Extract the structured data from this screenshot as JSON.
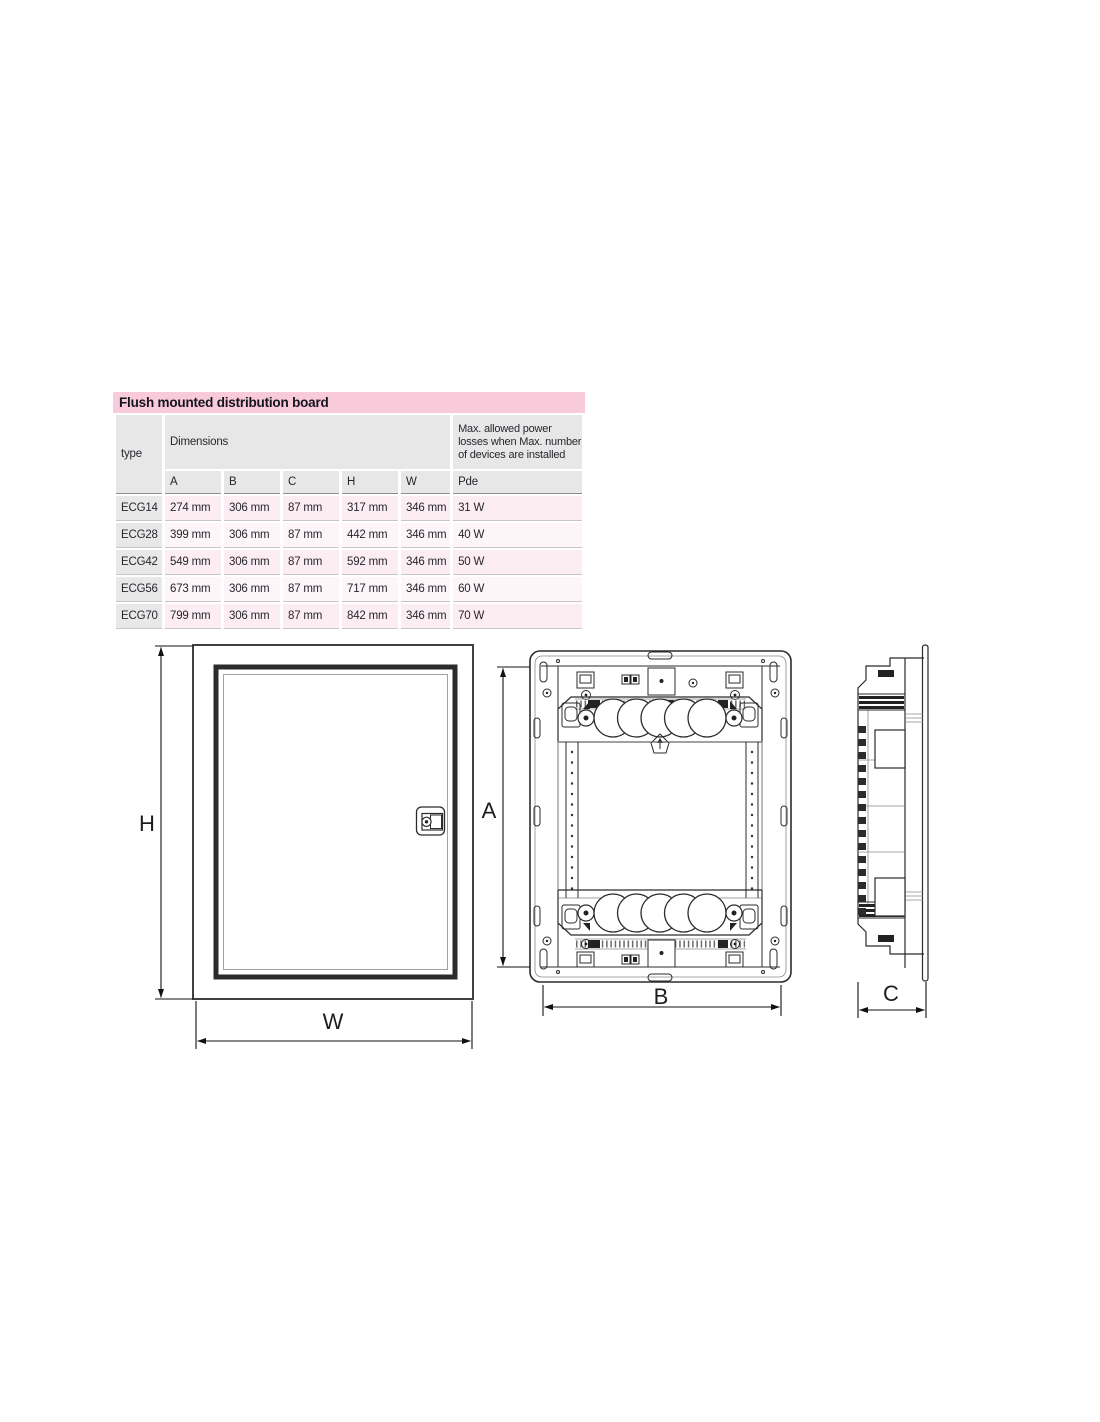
{
  "table": {
    "title": "Flush mounted distribution board",
    "header": {
      "type_label": "type",
      "dimensions_label": "Dimensions",
      "dim_columns": [
        "A",
        "B",
        "C",
        "H",
        "W"
      ],
      "power_note": "Max. allowed power losses when Max. number of devices are installed",
      "power_unit_label": "Pde"
    },
    "rows": [
      {
        "type": "ECG14",
        "a": "274 mm",
        "b": "306 mm",
        "c": "87 mm",
        "h": "317 mm",
        "w": "346 mm",
        "pde": "31 W"
      },
      {
        "type": "ECG28",
        "a": "399 mm",
        "b": "306 mm",
        "c": "87 mm",
        "h": "442 mm",
        "w": "346 mm",
        "pde": "40 W"
      },
      {
        "type": "ECG42",
        "a": "549 mm",
        "b": "306 mm",
        "c": "87 mm",
        "h": "592 mm",
        "w": "346 mm",
        "pde": "50 W"
      },
      {
        "type": "ECG56",
        "a": "673 mm",
        "b": "306 mm",
        "c": "87 mm",
        "h": "717 mm",
        "w": "346 mm",
        "pde": "60 W"
      },
      {
        "type": "ECG70",
        "a": "799 mm",
        "b": "306 mm",
        "c": "87 mm",
        "h": "842 mm",
        "w": "346 mm",
        "pde": "70 W"
      }
    ],
    "colors": {
      "title_bg": "#f9cada",
      "header_bg": "#e8e7e7",
      "row_pink": "#fcedf3",
      "row_pink_light": "#fdf5f8",
      "type_column_bg": "#e9e8e8"
    }
  },
  "drawings": {
    "front_view": {
      "height_label": "H",
      "width_label": "W"
    },
    "frame_view": {
      "height_label": "A",
      "width_label": "B"
    },
    "side_view": {
      "depth_label": "C"
    }
  }
}
